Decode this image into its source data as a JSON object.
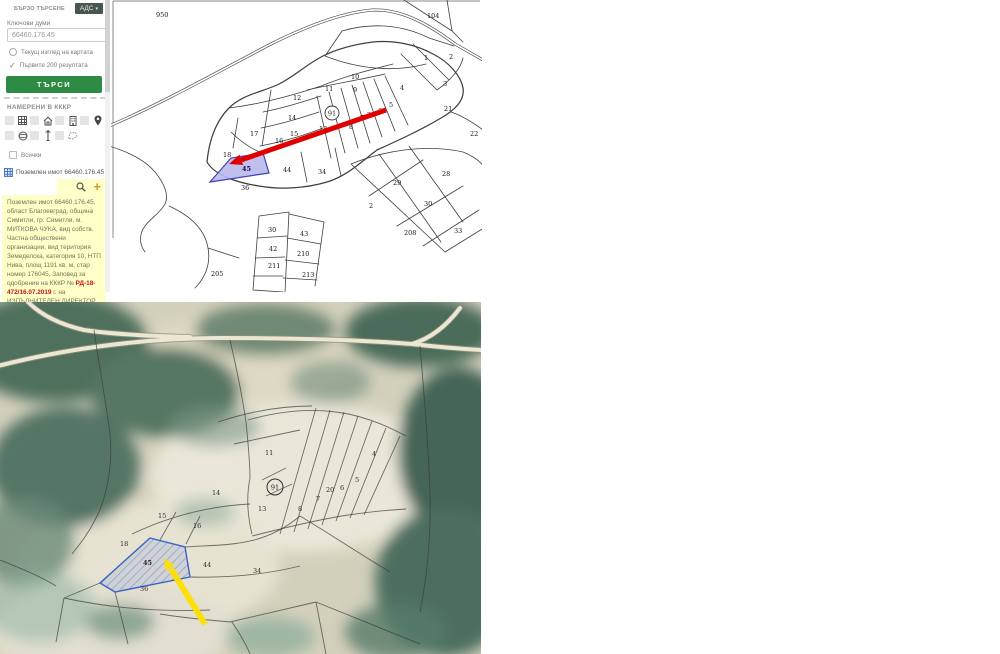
{
  "sidebar": {
    "tab_label": "БЪРЗО ТЪРСЕНЕ",
    "ads_button": "АДС",
    "ads_chevron": "▾",
    "keywords_label": "Ключови думи",
    "search_value": "66460.176.45",
    "option_current_view": "Текущ изглед на картата",
    "check_glyph": "✓",
    "option_first_200": "Първите 200 резултата",
    "search_button": "ТЪРСИ",
    "results_header": "НАМЕРЕНИ В КККР",
    "icons": {
      "row1": [
        "grid",
        "house",
        "building",
        "location-pin"
      ],
      "row2": [
        "globe",
        "street-lamp",
        "polygon-outline"
      ],
      "actions": [
        "magnifier",
        "plus"
      ]
    },
    "all_label": "Всички",
    "result_item": "Поземлен имот 66460.176.45",
    "plus_glyph": "+",
    "info_box": {
      "text_before": "Поземлен имот 66460.176.45, област Благоевград, община Симитли, гр. Симитли, м. МИТКОВА ЧУКА, вид собств. Частна обществени организации, вид територия Земеделска, категория 10, НТП Нива, площ 1191 кв. м, стар номер 176045, Заповед за одобрение на КККР № ",
      "highlight": "РД-18-472/16.07.2019",
      "text_after": " г. на ИЗПЪЛНИТЕЛЕН ДИРЕКТОР НА АГКК"
    }
  },
  "colors": {
    "search_button_green": "#2e8b44",
    "ads_button_dark": "#47564e",
    "info_box_yellow": "#ffffc8",
    "highlight_parcel_fill": "#b9b9ec",
    "highlight_parcel_stroke": "#4040b8",
    "red_arrow": "#e10000",
    "yellow_arrow": "#ffdf00",
    "plus_gold": "#cf9b1d"
  },
  "cadastral_map": {
    "landmark": "91",
    "highlighted_parcel": "45",
    "labels": [
      {
        "t": "950",
        "x": 45,
        "y": 17
      },
      {
        "t": "104",
        "x": 316,
        "y": 18
      },
      {
        "t": "1",
        "x": 313,
        "y": 60
      },
      {
        "t": "2",
        "x": 338,
        "y": 59
      },
      {
        "t": "3",
        "x": 332,
        "y": 86
      },
      {
        "t": "10",
        "x": 240,
        "y": 79
      },
      {
        "t": "11",
        "x": 214,
        "y": 91
      },
      {
        "t": "9",
        "x": 242,
        "y": 92
      },
      {
        "t": "4",
        "x": 289,
        "y": 90
      },
      {
        "t": "5",
        "x": 278,
        "y": 107
      },
      {
        "t": "6",
        "x": 267,
        "y": 113
      },
      {
        "t": "20",
        "x": 256,
        "y": 117
      },
      {
        "t": "7",
        "x": 249,
        "y": 120
      },
      {
        "t": "8",
        "x": 238,
        "y": 129
      },
      {
        "t": "13",
        "x": 208,
        "y": 131
      },
      {
        "t": "12",
        "x": 182,
        "y": 100
      },
      {
        "t": "14",
        "x": 177,
        "y": 120
      },
      {
        "t": "15",
        "x": 179,
        "y": 136
      },
      {
        "t": "17",
        "x": 139,
        "y": 136
      },
      {
        "t": "16",
        "x": 164,
        "y": 143
      },
      {
        "t": "18",
        "x": 112,
        "y": 157
      },
      {
        "t": "45",
        "x": 131,
        "y": 171,
        "cls": "hl"
      },
      {
        "t": "44",
        "x": 172,
        "y": 172
      },
      {
        "t": "34",
        "x": 207,
        "y": 174
      },
      {
        "t": "36",
        "x": 130,
        "y": 190
      },
      {
        "t": "29",
        "x": 282,
        "y": 185
      },
      {
        "t": "28",
        "x": 331,
        "y": 176
      },
      {
        "t": "2",
        "x": 258,
        "y": 208
      },
      {
        "t": "30",
        "x": 313,
        "y": 206
      },
      {
        "t": "208",
        "x": 293,
        "y": 235
      },
      {
        "t": "33",
        "x": 343,
        "y": 233
      },
      {
        "t": "22",
        "x": 359,
        "y": 136
      },
      {
        "t": "21",
        "x": 333,
        "y": 111
      },
      {
        "t": "30",
        "x": 157,
        "y": 232
      },
      {
        "t": "43",
        "x": 189,
        "y": 236
      },
      {
        "t": "42",
        "x": 158,
        "y": 251
      },
      {
        "t": "210",
        "x": 186,
        "y": 256
      },
      {
        "t": "211",
        "x": 157,
        "y": 268
      },
      {
        "t": "213",
        "x": 191,
        "y": 277
      },
      {
        "t": "205",
        "x": 100,
        "y": 276
      }
    ]
  },
  "aerial_map": {
    "landmark": "91",
    "highlighted_parcel": "45",
    "labels": [
      {
        "t": "11",
        "x": 265,
        "y": 153
      },
      {
        "t": "13",
        "x": 258,
        "y": 209
      },
      {
        "t": "8",
        "x": 298,
        "y": 209
      },
      {
        "t": "7",
        "x": 316,
        "y": 199
      },
      {
        "t": "20",
        "x": 326,
        "y": 190
      },
      {
        "t": "6",
        "x": 340,
        "y": 188
      },
      {
        "t": "5",
        "x": 355,
        "y": 180
      },
      {
        "t": "4",
        "x": 372,
        "y": 154
      },
      {
        "t": "14",
        "x": 212,
        "y": 193
      },
      {
        "t": "15",
        "x": 158,
        "y": 216
      },
      {
        "t": "16",
        "x": 193,
        "y": 226
      },
      {
        "t": "18",
        "x": 120,
        "y": 244
      },
      {
        "t": "45",
        "x": 143,
        "y": 263,
        "cls": "hl"
      },
      {
        "t": "44",
        "x": 203,
        "y": 265
      },
      {
        "t": "34",
        "x": 253,
        "y": 271
      },
      {
        "t": "36",
        "x": 140,
        "y": 289
      }
    ]
  }
}
